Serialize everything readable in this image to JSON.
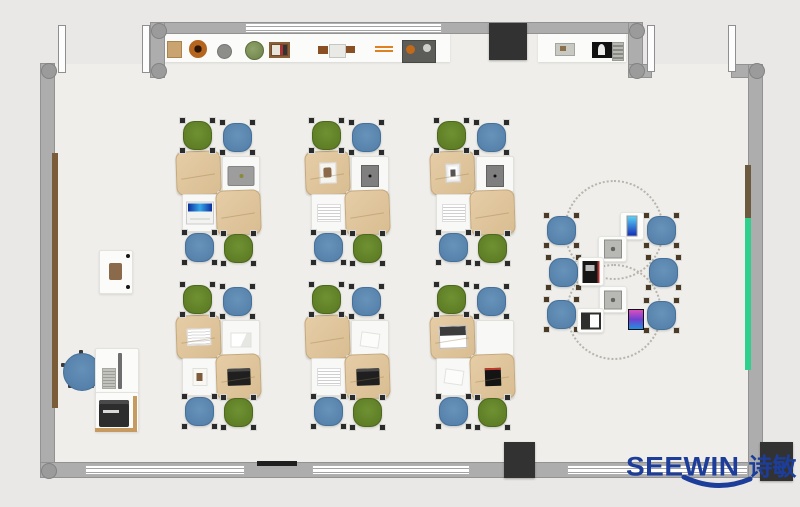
{
  "title": "classroom-floor-plan",
  "logo": {
    "text_en": "SEEWIN",
    "text_zh": "诗敏",
    "color": "#1c3d99"
  },
  "palette": {
    "exterior": "#e9e8e6",
    "floor": "#efeeea",
    "wall": "#adadad",
    "window": "#ffffff",
    "chair_green": "#66862c",
    "chair_blue": "#5b86ae",
    "desk": "#f8f8f6",
    "bag_tan": "#dfc49d",
    "pillar": "#323232",
    "green_board": "#2fcf8e",
    "wood_brown": "#7a5c38",
    "logo_blue": "#1c3d99"
  },
  "floor_pieces": [
    {
      "name": "floor-top-band",
      "x": 165,
      "y": 33,
      "w": 463,
      "h": 31
    },
    {
      "name": "floor-main",
      "x": 55,
      "y": 64,
      "w": 693,
      "h": 398
    }
  ],
  "walls": [
    {
      "name": "top-wall",
      "x": 150,
      "y": 22,
      "w": 493,
      "h": 12
    },
    {
      "name": "top-left-wall",
      "x": 150,
      "y": 22,
      "w": 15,
      "h": 56
    },
    {
      "name": "left-wall",
      "x": 40,
      "y": 63,
      "w": 15,
      "h": 415
    },
    {
      "name": "bottom-wall",
      "x": 40,
      "y": 462,
      "w": 723,
      "h": 16
    },
    {
      "name": "top-step-wall",
      "x": 628,
      "y": 22,
      "w": 15,
      "h": 56
    },
    {
      "name": "step-stub-wall",
      "x": 628,
      "y": 64,
      "w": 24,
      "h": 14
    },
    {
      "name": "right-top-wall",
      "x": 731,
      "y": 64,
      "w": 32,
      "h": 14
    },
    {
      "name": "right-wall",
      "x": 748,
      "y": 64,
      "w": 15,
      "h": 414
    }
  ],
  "windows": [
    {
      "name": "top-window",
      "x": 245,
      "y": 23,
      "w": 197,
      "h": 10
    },
    {
      "name": "bottom-window-1",
      "x": 85,
      "y": 465,
      "w": 160,
      "h": 10
    },
    {
      "name": "bottom-window-2",
      "x": 312,
      "y": 465,
      "w": 158,
      "h": 10
    },
    {
      "name": "bottom-window-3",
      "x": 567,
      "y": 465,
      "w": 181,
      "h": 10
    }
  ],
  "posts": [
    [
      151,
      23
    ],
    [
      151,
      63
    ],
    [
      41,
      63
    ],
    [
      41,
      463
    ],
    [
      629,
      23
    ],
    [
      629,
      63
    ],
    [
      749,
      63
    ]
  ],
  "door_leaves": [
    [
      58,
      25,
      6,
      46
    ],
    [
      142,
      25,
      6,
      46
    ],
    [
      647,
      25,
      6,
      45
    ],
    [
      728,
      25,
      6,
      45
    ]
  ],
  "pillars": [
    {
      "name": "pillar-top",
      "x": 489,
      "y": 23,
      "w": 38,
      "h": 37
    },
    {
      "name": "pillar-bottom-middle",
      "x": 504,
      "y": 442,
      "w": 31,
      "h": 36
    },
    {
      "name": "pillar-bottom-right",
      "x": 760,
      "y": 442,
      "w": 33,
      "h": 39
    }
  ],
  "shelf_counters": [
    [
      165,
      33,
      285,
      29
    ],
    [
      538,
      33,
      88,
      29
    ]
  ],
  "shelf_items": [
    {
      "kind": "box-tan",
      "x": 167,
      "y": 41,
      "w": 13,
      "h": 15
    },
    {
      "kind": "pot-brown",
      "x": 189,
      "y": 40,
      "w": 18,
      "h": 18
    },
    {
      "kind": "ball-gray",
      "x": 217,
      "y": 44,
      "w": 13,
      "h": 13
    },
    {
      "kind": "plant-green",
      "x": 245,
      "y": 41,
      "w": 17,
      "h": 17
    },
    {
      "kind": "photo-frame",
      "x": 269,
      "y": 42,
      "w": 21,
      "h": 16
    },
    {
      "kind": "bench-brown",
      "x": 318,
      "y": 44,
      "w": 37,
      "h": 12
    },
    {
      "kind": "orange-lines",
      "x": 375,
      "y": 46,
      "w": 18,
      "h": 7
    },
    {
      "kind": "clutter-tray",
      "x": 402,
      "y": 40,
      "w": 32,
      "h": 21
    },
    {
      "kind": "box-gray",
      "x": 555,
      "y": 43,
      "w": 18,
      "h": 11
    },
    {
      "kind": "printer-small",
      "x": 592,
      "y": 42,
      "w": 20,
      "h": 16
    },
    {
      "kind": "vent",
      "x": 612,
      "y": 42,
      "w": 10,
      "h": 17
    }
  ],
  "wall_fixtures": [
    {
      "name": "left-wall-wood-panel",
      "x": 52,
      "y": 153,
      "w": 6,
      "h": 255,
      "color": "#7a5c38"
    },
    {
      "name": "right-wall-wood-panel",
      "x": 745,
      "y": 165,
      "w": 6,
      "h": 53,
      "color": "#6b5a3e"
    },
    {
      "name": "right-wall-green-board",
      "x": 745,
      "y": 218,
      "w": 6,
      "h": 152,
      "color": "#2fcf8e"
    },
    {
      "name": "bottom-wall-rail",
      "x": 257,
      "y": 461,
      "w": 40,
      "h": 5,
      "color": "#1f1f1f"
    }
  ],
  "cluster_template": {
    "chairs": [
      {
        "pos": "tl",
        "dx": 4,
        "dy": -33
      },
      {
        "pos": "tr",
        "dx": 44,
        "dy": -31
      },
      {
        "pos": "bl",
        "dx": 6,
        "dy": 79
      },
      {
        "pos": "br",
        "dx": 45,
        "dy": 80
      }
    ],
    "desks": [
      {
        "pos": "tl",
        "dx": 0,
        "dy": 0,
        "w": 41,
        "h": 40
      },
      {
        "pos": "tr",
        "dx": 45,
        "dy": 4,
        "w": 36,
        "h": 38
      },
      {
        "pos": "bl",
        "dx": 5,
        "dy": 42,
        "w": 34,
        "h": 36
      },
      {
        "pos": "br",
        "dx": 40,
        "dy": 39,
        "w": 41,
        "h": 41
      }
    ]
  },
  "clusters": [
    {
      "id": "A",
      "x": 177,
      "y": 152,
      "chair_colors": [
        "green",
        "blue",
        "blue",
        "green"
      ],
      "desk_items": [
        "bag",
        "laptop-gray",
        "laptop-blue",
        "bag"
      ]
    },
    {
      "id": "B",
      "x": 306,
      "y": 152,
      "chair_colors": [
        "green",
        "blue",
        "blue",
        "green"
      ],
      "desk_items": [
        "bag-photo",
        "tablet-dark",
        "book",
        "bag"
      ]
    },
    {
      "id": "C",
      "x": 431,
      "y": 152,
      "chair_colors": [
        "green",
        "blue",
        "blue",
        "green"
      ],
      "desk_items": [
        "bag-frame",
        "tablet-dark",
        "book",
        "bag"
      ]
    },
    {
      "id": "D",
      "x": 177,
      "y": 316,
      "chair_colors": [
        "green",
        "blue",
        "blue",
        "green"
      ],
      "desk_items": [
        "bag-book",
        "paper-folded",
        "photo-small",
        "bag-laptop-dark"
      ]
    },
    {
      "id": "E",
      "x": 306,
      "y": 316,
      "chair_colors": [
        "green",
        "blue",
        "blue",
        "green"
      ],
      "desk_items": [
        "bag",
        "paper",
        "book",
        "bag-laptop-dark"
      ]
    },
    {
      "id": "F",
      "x": 431,
      "y": 316,
      "chair_colors": [
        "green",
        "blue",
        "blue",
        "green"
      ],
      "desk_items": [
        "bag-laptop-white",
        "none",
        "paper",
        "bag-laptop-red"
      ]
    }
  ],
  "discussion_area": {
    "dashed_circles": [
      {
        "cx": 612,
        "cy": 228,
        "r": 48
      },
      {
        "cx": 612,
        "cy": 310,
        "r": 46
      }
    ],
    "chairs": [
      [
        545,
        214
      ],
      [
        547,
        256
      ],
      [
        545,
        298
      ],
      [
        645,
        214
      ],
      [
        647,
        256
      ],
      [
        645,
        299
      ]
    ],
    "tables": [
      {
        "kind": "table-phone-blue",
        "x": 620,
        "y": 212,
        "w": 22,
        "h": 26
      },
      {
        "kind": "table-device",
        "x": 598,
        "y": 236,
        "w": 27,
        "h": 24
      },
      {
        "kind": "laptop-black",
        "x": 578,
        "y": 257,
        "w": 24,
        "h": 27
      },
      {
        "kind": "table-device",
        "x": 599,
        "y": 286,
        "w": 26,
        "h": 25
      },
      {
        "kind": "laptop-open-white",
        "x": 577,
        "y": 308,
        "w": 25,
        "h": 23
      },
      {
        "kind": "phone-color",
        "x": 628,
        "y": 309,
        "w": 14,
        "h": 19
      }
    ]
  },
  "teacher_station": {
    "podium": {
      "x": 99,
      "y": 250,
      "w": 32,
      "h": 42
    },
    "chair": {
      "cx": 81,
      "cy": 371,
      "d": 36
    },
    "desk": {
      "x": 95,
      "y": 348,
      "w": 42,
      "h": 44
    },
    "printer_desk": {
      "x": 95,
      "y": 392,
      "w": 42,
      "h": 38
    }
  }
}
